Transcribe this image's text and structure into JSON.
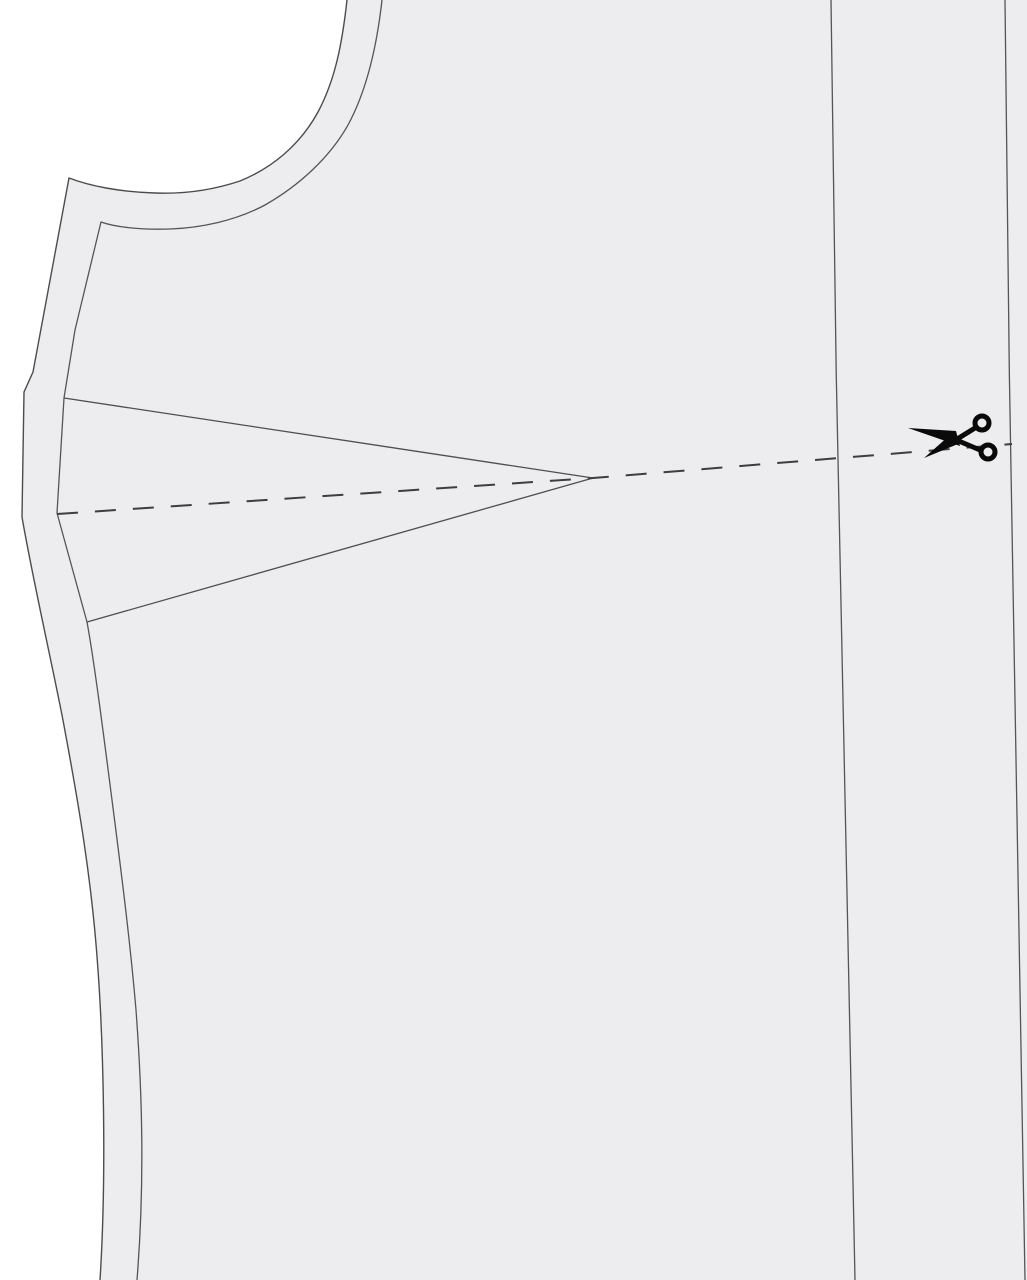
{
  "diagram": {
    "type": "sewing-pattern-cutting-guide",
    "description": "Bodice front pattern piece with seam allowance, bust dart, and a dashed slash/cut line marked by a scissors symbol"
  },
  "colors": {
    "background": "#ffffff",
    "piece_fill": "#edecee",
    "outline": "#4c4c4c",
    "seam_line": "#555555",
    "dart_line": "#4f4f4f",
    "dashed_cut_line": "#3e3e3e",
    "scissors": "#0a0a0a"
  },
  "icons": [
    {
      "name": "scissors-icon",
      "meaning": "cut along dashed line",
      "glyph": "✂"
    }
  ]
}
